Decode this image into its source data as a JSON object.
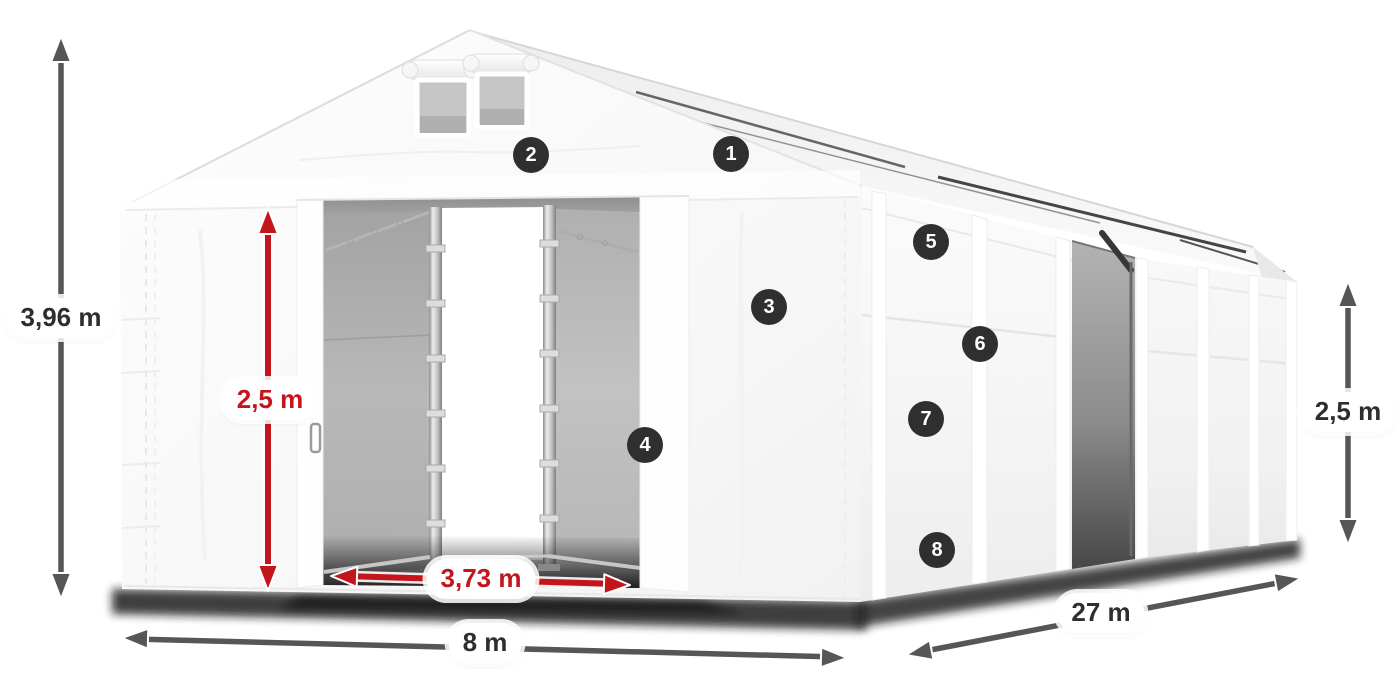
{
  "diagram": {
    "dimensions": [
      {
        "id": "total-height",
        "label": "3,96 m",
        "style": "gray"
      },
      {
        "id": "door-height",
        "label": "2,5 m",
        "style": "red"
      },
      {
        "id": "door-width",
        "label": "3,73 m",
        "style": "red"
      },
      {
        "id": "width",
        "label": "8 m",
        "style": "gray"
      },
      {
        "id": "length",
        "label": "27 m",
        "style": "gray"
      },
      {
        "id": "side-height",
        "label": "2,5 m",
        "style": "gray"
      }
    ],
    "callouts": [
      {
        "number": "1"
      },
      {
        "number": "2"
      },
      {
        "number": "3"
      },
      {
        "number": "4"
      },
      {
        "number": "5"
      },
      {
        "number": "6"
      },
      {
        "number": "7"
      },
      {
        "number": "8"
      }
    ],
    "colors": {
      "accent_red": "#c3151c",
      "arrow_gray": "#565656",
      "callout_background": "#2f2f2f",
      "callout_number": "#ffffff",
      "label_text": "#2e2e2e"
    }
  }
}
